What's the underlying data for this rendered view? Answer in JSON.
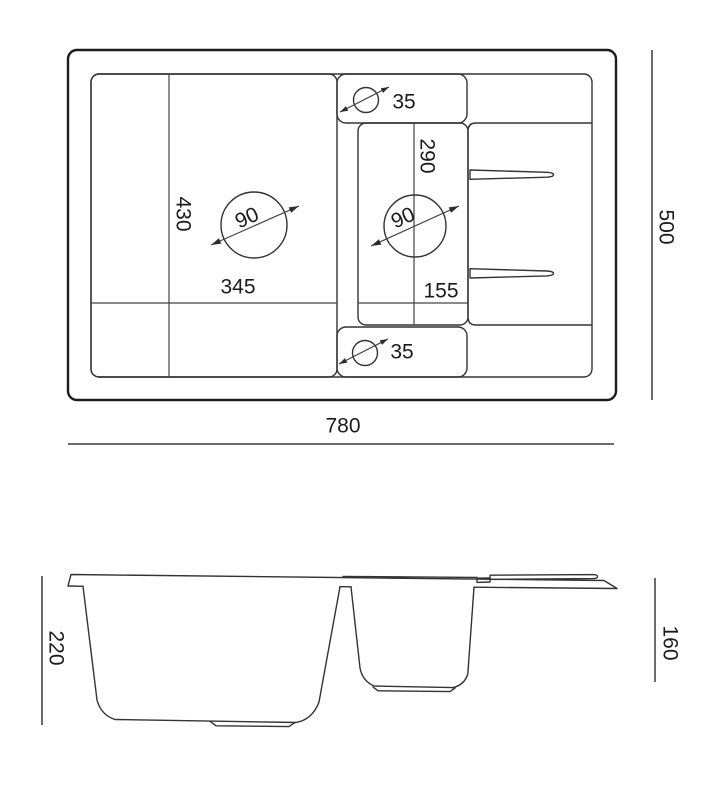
{
  "drawing": {
    "subject": "kitchen-sink-dimension-drawing",
    "background": "#ffffff",
    "line_color": "#333333",
    "strong_line_color": "#1c1c1c",
    "text_color": "#1b1b1b",
    "top_view": {
      "overall": {
        "width": "780",
        "depth": "500"
      },
      "main_bowl": {
        "length": "430",
        "width": "345",
        "drain_diameter": "90"
      },
      "half_bowl": {
        "length": "290",
        "width": "155",
        "drain_diameter": "90"
      },
      "tap_holes": {
        "top_diameter": "35",
        "bottom_diameter": "35"
      }
    },
    "front_view": {
      "main_bowl_depth": "220",
      "half_bowl_depth": "160"
    }
  }
}
